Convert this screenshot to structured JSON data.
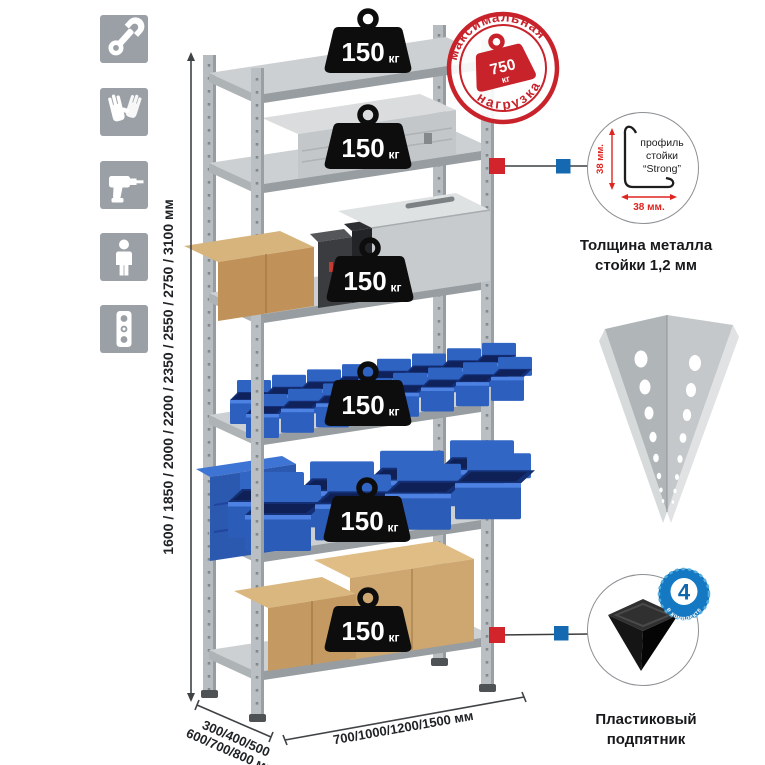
{
  "page": {
    "background": "#ffffff"
  },
  "sidebar": {
    "icons": [
      "wrench",
      "gloves",
      "drill",
      "person",
      "level"
    ]
  },
  "dimensions": {
    "height": "1600 / 1850 / 2000 / 2200 / 2350 / 2550 / 2750 / 3100 мм",
    "depth_line1": "300/400/500",
    "depth_line2": "600/700/800 мм",
    "width": "700/1000/1200/1500 мм"
  },
  "stamp": {
    "arc_top": "максимальная",
    "arc_bottom": "нагрузка",
    "value": "750",
    "unit": "кг",
    "color": "#c8232b"
  },
  "shelves": {
    "unit": "кг",
    "loads": [
      "150",
      "150",
      "150",
      "150",
      "150",
      "150"
    ]
  },
  "profile": {
    "text1": "профиль",
    "text2": "стойки",
    "text3": "“Strong”",
    "dim_v": "38 мм.",
    "dim_h": "38 мм.",
    "caption1": "Толщина металла",
    "caption2": "стойки 1,2 мм"
  },
  "foot": {
    "badge_value": "4",
    "badge_arc": "в комплекте",
    "caption1": "Пластиковый",
    "caption2": "подпятник"
  },
  "colors": {
    "stamp_red": "#c8232b",
    "callout_red": "#d2252b",
    "callout_blue": "#1569b0",
    "bin_blue": "#2b5cb8",
    "metal_gray": "#b6bcbf",
    "icon_tile_gray": "#9aa0a5",
    "dim_red": "#e02420"
  }
}
